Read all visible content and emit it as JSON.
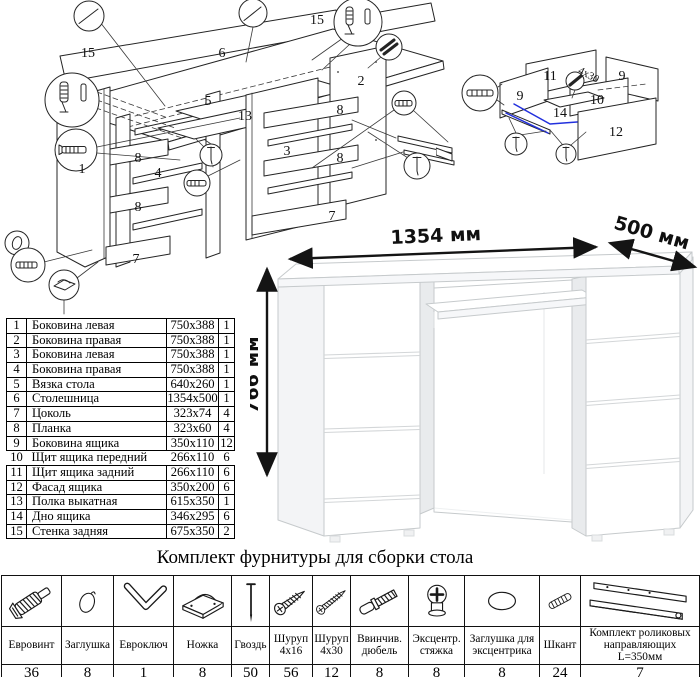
{
  "parts_table": {
    "rows": [
      {
        "num": "1",
        "name": "Боковина левая",
        "size": "750x388",
        "qty": "1"
      },
      {
        "num": "2",
        "name": "Боковина правая",
        "size": "750x388",
        "qty": "1"
      },
      {
        "num": "3",
        "name": "Боковина левая",
        "size": "750x388",
        "qty": "1"
      },
      {
        "num": "4",
        "name": "Боковина правая",
        "size": "750x388",
        "qty": "1"
      },
      {
        "num": "5",
        "name": "Вязка стола",
        "size": "640x260",
        "qty": "1"
      },
      {
        "num": "6",
        "name": "Столешница",
        "size": "1354x500",
        "qty": "1"
      },
      {
        "num": "7",
        "name": "Цоколь",
        "size": "323x74",
        "qty": "4"
      },
      {
        "num": "8",
        "name": "Планка",
        "size": "323x60",
        "qty": "4"
      },
      {
        "num": "9",
        "name": "Боковина ящика",
        "size": "350x110",
        "qty": "12"
      },
      {
        "num": "10",
        "name": "Щит ящика передний",
        "size": "266x110",
        "qty": "6"
      },
      {
        "num": "11",
        "name": "Щит ящика задний",
        "size": "266x110",
        "qty": "6"
      },
      {
        "num": "12",
        "name": "Фасад ящика",
        "size": "350x200",
        "qty": "6"
      },
      {
        "num": "13",
        "name": "Полка выкатная",
        "size": "615x350",
        "qty": "1"
      },
      {
        "num": "14",
        "name": "Дно ящика",
        "size": "346x295",
        "qty": "6"
      },
      {
        "num": "15",
        "name": "Стенка задняя",
        "size": "675x350",
        "qty": "2"
      }
    ]
  },
  "desk_dimensions": {
    "width": "1354 мм",
    "depth": "500 мм",
    "height": "766 мм"
  },
  "diagrams": {
    "main": {
      "labels": [
        "15",
        "15",
        "6",
        "1",
        "5",
        "13",
        "8",
        "4",
        "8",
        "7",
        "3",
        "2",
        "8",
        "8",
        "7"
      ]
    },
    "drawer": {
      "labels": [
        "11",
        "9",
        "9",
        "10",
        "14",
        "12"
      ],
      "screw_note": "4x30"
    }
  },
  "hardware_kit": {
    "title": "Комплект фурнитуры для сборки стола",
    "items": [
      {
        "name": "Евровинт",
        "qty": "36",
        "icon": "euro-screw"
      },
      {
        "name": "Заглушка",
        "qty": "8",
        "icon": "cap"
      },
      {
        "name": "Евроключ",
        "qty": "1",
        "icon": "hex-key"
      },
      {
        "name": "Ножка",
        "qty": "8",
        "icon": "foot"
      },
      {
        "name": "Гвоздь",
        "qty": "50",
        "icon": "nail"
      },
      {
        "name": "Шуруп 4x16",
        "qty": "56",
        "icon": "screw-short"
      },
      {
        "name": "Шуруп 4x30",
        "qty": "12",
        "icon": "screw-long"
      },
      {
        "name": "Ввинчив. дюбель",
        "qty": "8",
        "icon": "screw-in-dowel"
      },
      {
        "name": "Эксцентр. стяжка",
        "qty": "8",
        "icon": "cam-lock"
      },
      {
        "name": "Заглушка для эксцентрика",
        "qty": "8",
        "icon": "cam-cap"
      },
      {
        "name": "Шкант",
        "qty": "24",
        "icon": "wood-dowel"
      },
      {
        "name": "Комплект роликовых направляющих L=350мм",
        "qty": "7",
        "icon": "roller-rails"
      }
    ]
  },
  "accent_blue": "#2230dd"
}
